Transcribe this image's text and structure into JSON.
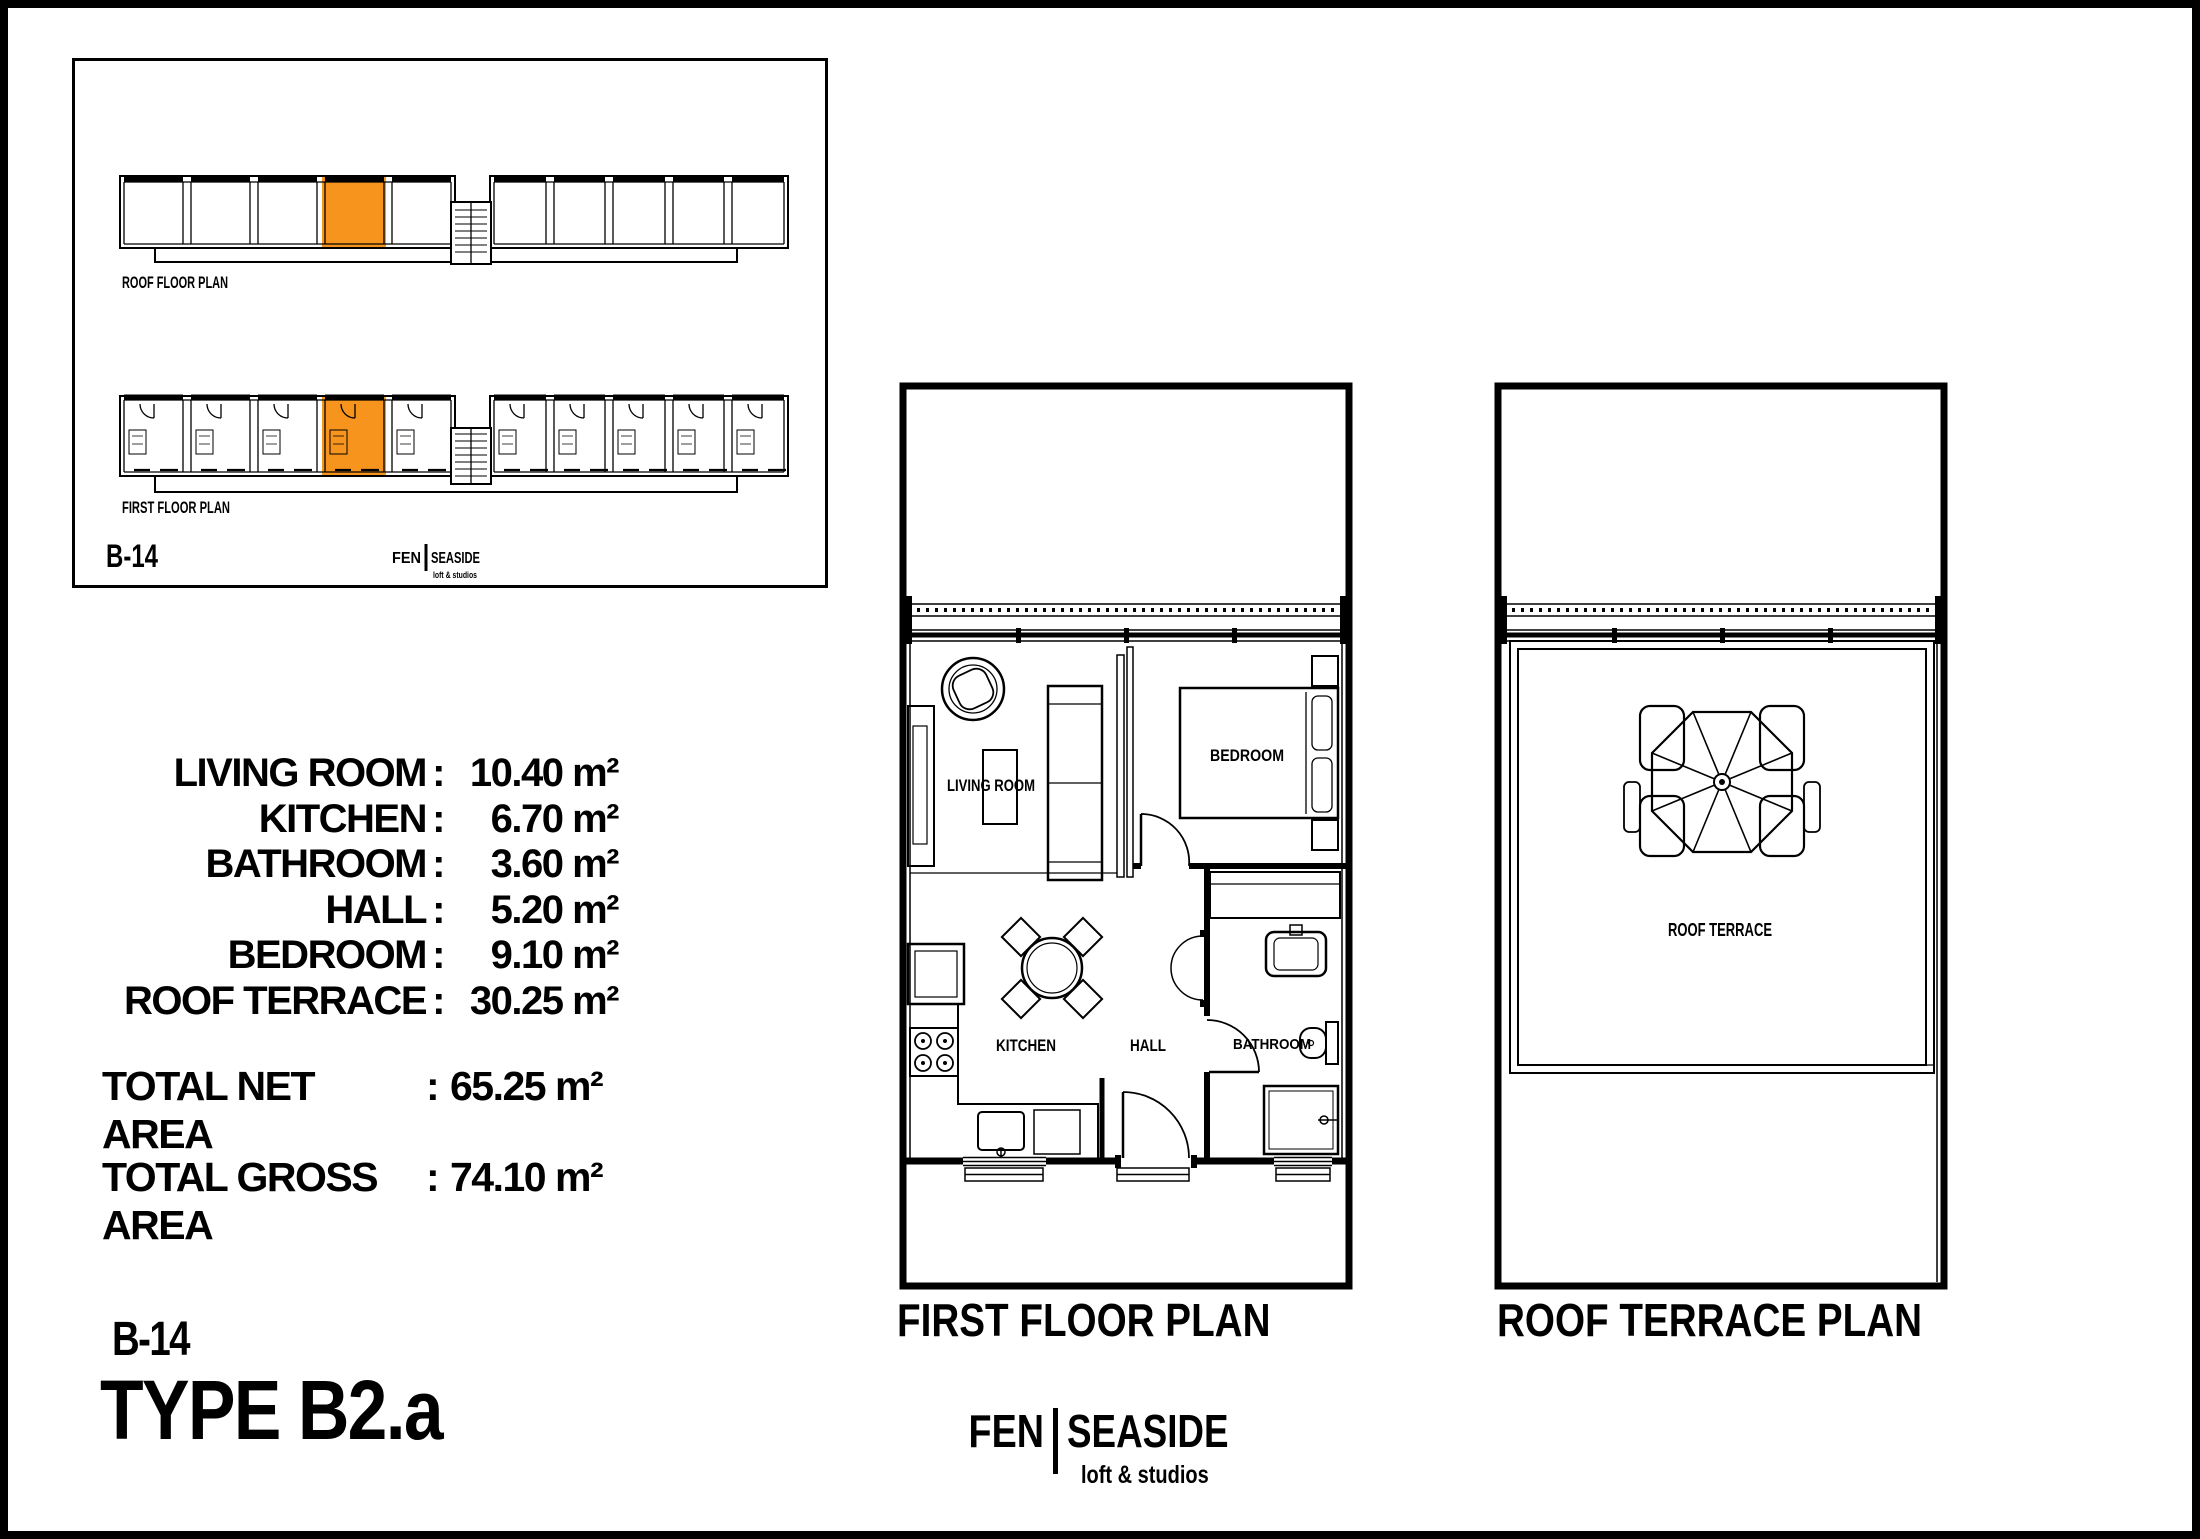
{
  "page": {
    "background": "#ffffff",
    "line_color": "#000000",
    "highlight_color": "#F7941D"
  },
  "unit": {
    "code": "B-14",
    "type_title": "TYPE B2.a"
  },
  "brand": {
    "left": "FEN",
    "right": "SEASIDE",
    "tagline": "loft & studios"
  },
  "overview_inset": {
    "roof_plan_label": "ROOF FLOOR PLAN",
    "first_plan_label": "FIRST FLOOR PLAN",
    "unit_code": "B-14"
  },
  "area_table": {
    "separator": ":",
    "rows": [
      {
        "label": "LIVING ROOM",
        "value": "10.40 m²"
      },
      {
        "label": "KITCHEN",
        "value": "6.70 m²"
      },
      {
        "label": "BATHROOM",
        "value": "3.60 m²"
      },
      {
        "label": "HALL",
        "value": "5.20 m²"
      },
      {
        "label": "BEDROOM",
        "value": "9.10 m²"
      },
      {
        "label": "ROOF TERRACE",
        "value": "30.25 m²"
      }
    ],
    "totals": [
      {
        "label": "TOTAL NET AREA",
        "value": "65.25 m²"
      },
      {
        "label": "TOTAL GROSS AREA",
        "value": "74.10 m²"
      }
    ]
  },
  "plans": {
    "first_floor": {
      "title": "FIRST FLOOR PLAN",
      "labels": {
        "living_room": "LIVING ROOM",
        "bedroom": "BEDROOM",
        "kitchen": "KITCHEN",
        "hall": "HALL",
        "bathroom": "BATHROOM"
      }
    },
    "roof_terrace": {
      "title": "ROOF TERRACE PLAN",
      "labels": {
        "roof_terrace": "ROOF TERRACE"
      }
    }
  }
}
